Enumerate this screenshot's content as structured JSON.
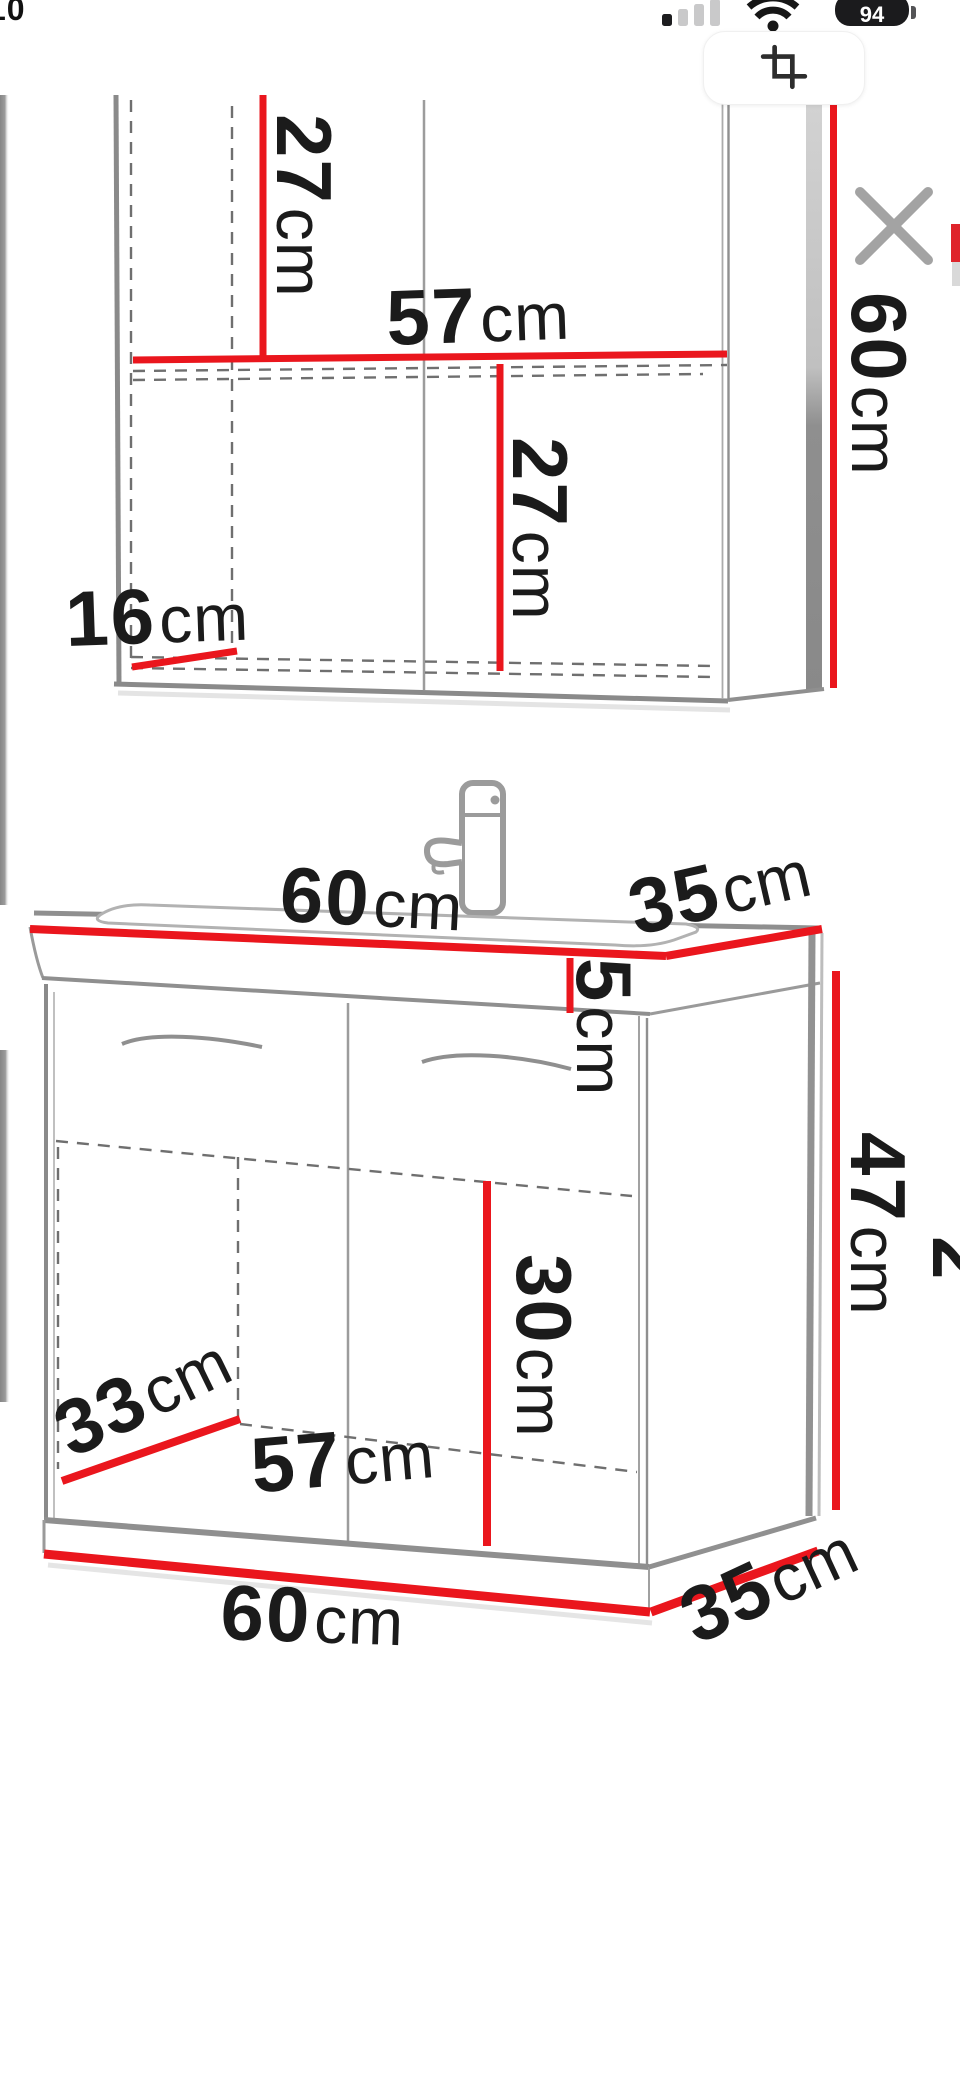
{
  "status_bar": {
    "time": "10",
    "battery_percent": "94",
    "icons": {
      "signal": "cellular-signal-1-of-4",
      "wifi": "wifi",
      "battery": "battery-level-badge"
    }
  },
  "toolbar": {
    "icons": {
      "crop": "crop-photo",
      "close": "close-viewer"
    }
  },
  "accent_colors": {
    "dimension_red": "#ea161d",
    "drawing_gray": "#8d8d8d",
    "text_black": "#1b1b1b"
  },
  "diagram": {
    "description_units": "cm",
    "labels": {
      "mirror_depth_left": {
        "value": "27",
        "unit": "cm"
      },
      "mirror_inner_width": {
        "value": "57",
        "unit": "cm"
      },
      "mirror_depth_right": {
        "value": "27",
        "unit": "cm"
      },
      "mirror_shelf_depth": {
        "value": "16",
        "unit": "cm"
      },
      "mirror_height": {
        "value": "60",
        "unit": "cm"
      },
      "vanity_top_width": {
        "value": "60",
        "unit": "cm"
      },
      "vanity_top_depth": {
        "value": "35",
        "unit": "cm"
      },
      "vanity_top_thickness": {
        "value": "5",
        "unit": "cm"
      },
      "vanity_inner_height": {
        "value": "30",
        "unit": "cm"
      },
      "vanity_height": {
        "value": "47",
        "unit": "cm"
      },
      "vanity_floor_depth": {
        "value": "33",
        "unit": "cm"
      },
      "vanity_inner_width": {
        "value": "57",
        "unit": "cm"
      },
      "vanity_bottom_width": {
        "value": "60",
        "unit": "cm"
      },
      "vanity_bottom_depth": {
        "value": "35",
        "unit": "cm"
      },
      "adjacent_partial": {
        "value": "2",
        "unit": ""
      }
    }
  }
}
